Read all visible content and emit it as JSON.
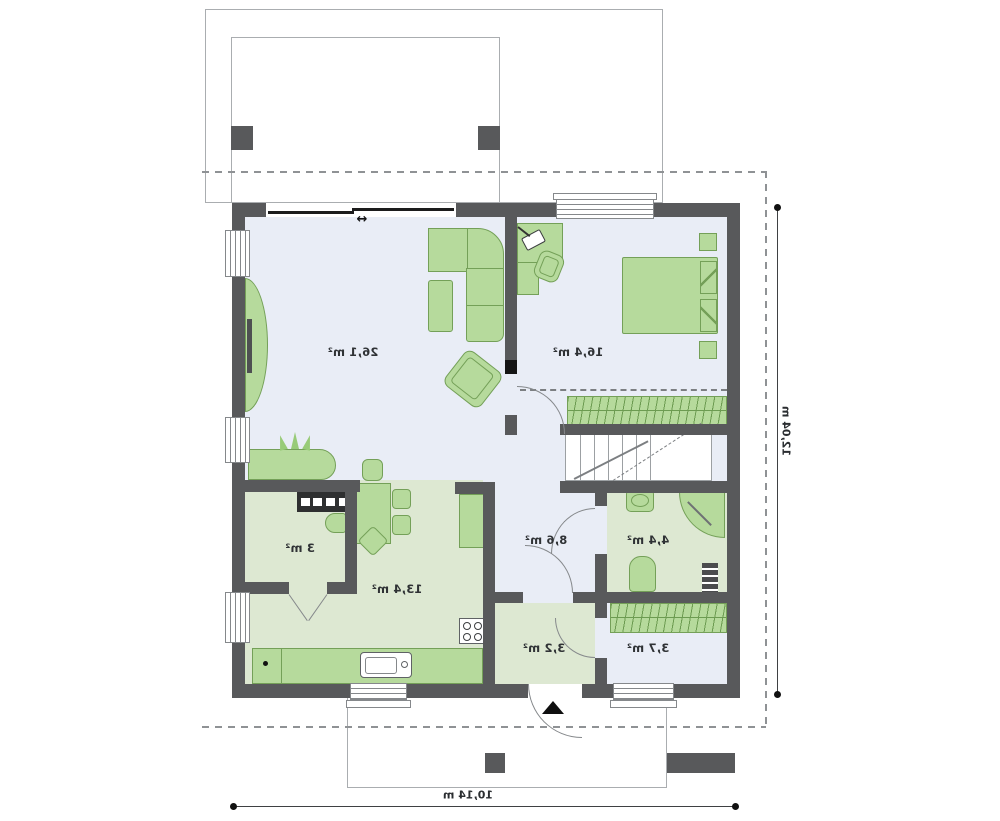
{
  "plan": {
    "rooms": {
      "living": {
        "area": "26,1 m²"
      },
      "bedroom": {
        "area": "16,4 m²"
      },
      "hall": {
        "area": "8,6 m²"
      },
      "bathroom": {
        "area": "4,4 m²"
      },
      "kitchen": {
        "area": "13,4 m²"
      },
      "pantry": {
        "area": "3 m²"
      },
      "vestibule": {
        "area": "3,2 m²"
      },
      "closet": {
        "area": "3,7 m²"
      }
    },
    "dimensions": {
      "overall_width": "10,14 m",
      "overall_height": "12,04 m"
    },
    "symbols": {
      "sliding_door_arrow": "↔"
    },
    "colors": {
      "wall": "#58595b",
      "floor_main": "#e9edf6",
      "floor_service": "#dde8d2",
      "furniture": "#b6da9c",
      "furniture_outline": "#74a058",
      "dashed_guide": "#8f9295"
    }
  }
}
